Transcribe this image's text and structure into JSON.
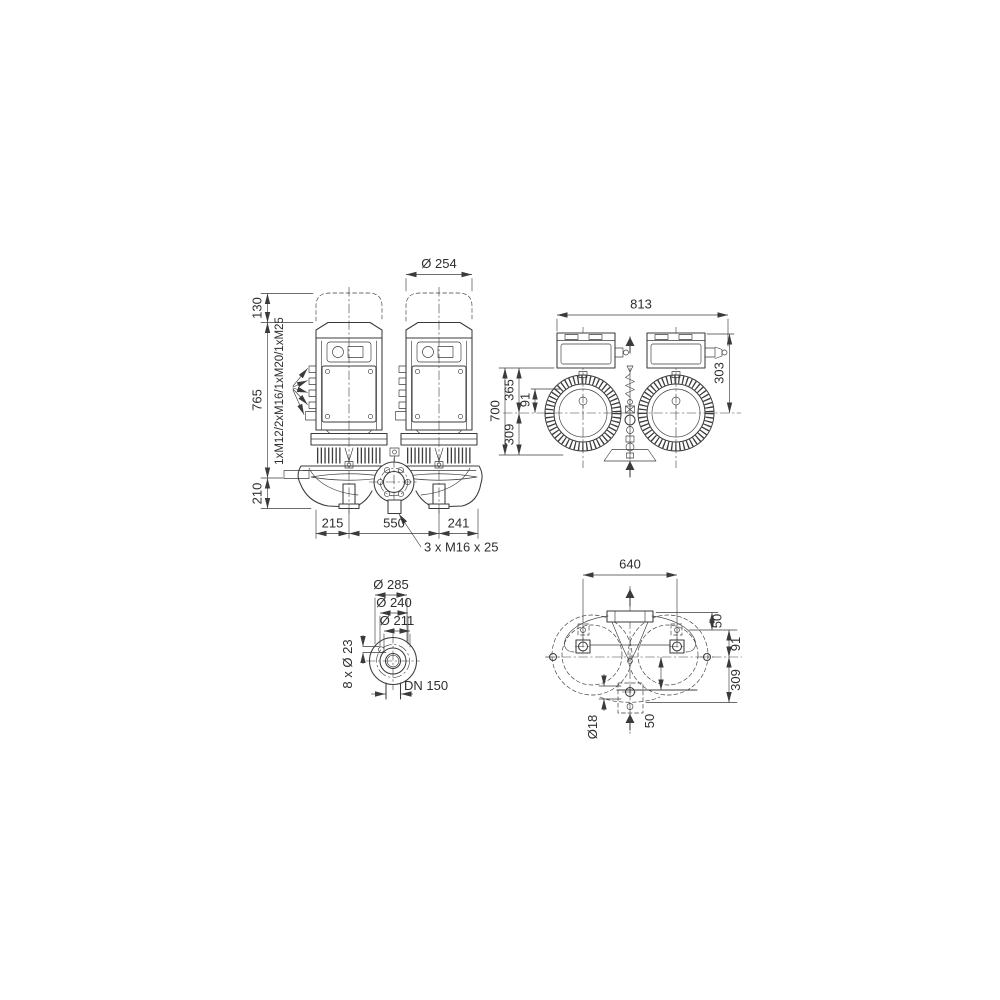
{
  "ink": "#3b3b3b",
  "background": "#ffffff",
  "front": {
    "motor_diameter": "Ø 254",
    "height_motor_reserve": "130",
    "height_pump": "765",
    "height_base": "210",
    "width_left": "215",
    "width_center": "550",
    "width_right": "241",
    "cable_glands": "1xM12/2xM16/1xM20/1xM25",
    "tapping_note": "3 x M16 x 25"
  },
  "top": {
    "overall_width": "813",
    "depth_terminal_box": "303",
    "overall_depth": "700",
    "depth_front": "365",
    "depth_axis_offset": "91",
    "depth_rear": "309"
  },
  "flange": {
    "outer_diameter": "Ø 285",
    "bolt_circle_diameter": "Ø 240",
    "raised_face_diameter": "Ø 211",
    "bolt_holes": "8 x Ø 23",
    "nominal_bore": "DN 150"
  },
  "base": {
    "bolt_spacing": "640",
    "offset_top": "50",
    "offset_axis": "91",
    "offset_rear": "309",
    "anchor_hole": "Ø18",
    "offset_bottom": "50"
  }
}
